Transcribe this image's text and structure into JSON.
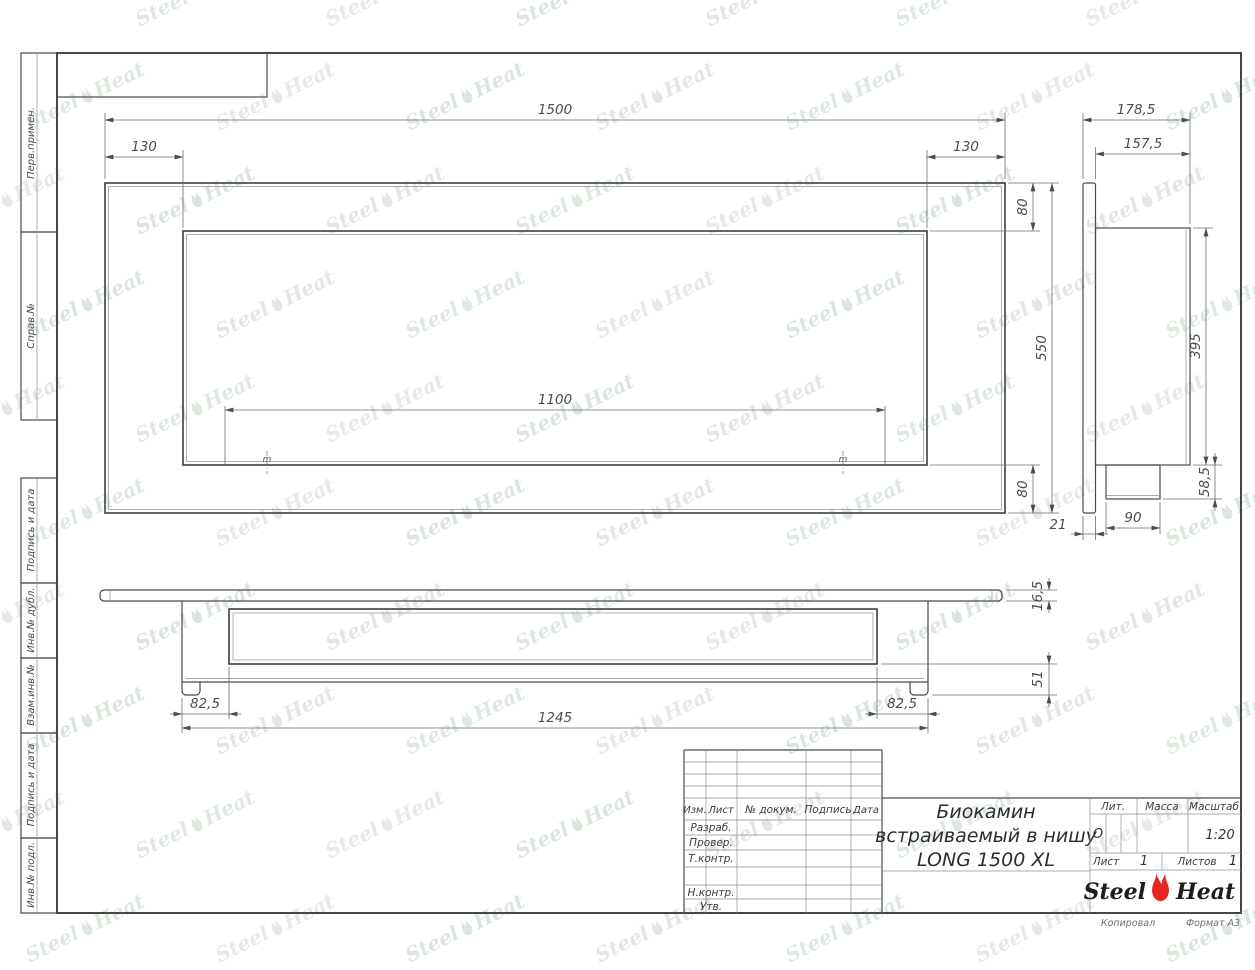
{
  "watermark": {
    "text_left": "Steel",
    "text_right": "Heat"
  },
  "sidebar": {
    "labels": [
      "Перв.примен.",
      "Справ.№",
      "Подпись и дата",
      "Инв.№ дубл.",
      "Взам.инв.№",
      "Подпись и дата",
      "Инв.№ подл."
    ]
  },
  "drawing": {
    "front_view": {
      "dims": {
        "overall_width": "1500",
        "left_offset": "130",
        "right_offset": "130",
        "top_offset": "80",
        "overall_height": "550",
        "opening_width": "1100",
        "bottom_offset": "80"
      },
      "mount_mark": "m"
    },
    "side_view": {
      "dims": {
        "overall_depth": "178,5",
        "body_depth": "157,5",
        "body_height": "395",
        "box_height": "58,5",
        "box_depth": "90",
        "panel_thickness": "21"
      }
    },
    "plan_view": {
      "dims": {
        "flange_thickness": "16,5",
        "body_drop": "51",
        "left_inset": "82,5",
        "body_length": "1245",
        "right_inset": "82,5"
      }
    }
  },
  "title_block": {
    "header_cols": [
      "Изм.",
      "Лист",
      "№ докум.",
      "Подпись",
      "Дата"
    ],
    "row_labels": [
      "Разраб.",
      "Провер.",
      "Т.контр.",
      "Н.контр.",
      "Утв."
    ],
    "title_lines": [
      "Биокамин",
      "встраиваемый в нишу",
      "LONG 1500 XL"
    ],
    "lit_label": "Лит.",
    "lit_value": "О",
    "mass_label": "Масса",
    "scale_label": "Масштаб",
    "scale_value": "1:20",
    "sheet_label": "Лист",
    "sheet_value": "1",
    "sheets_label": "Листов",
    "sheets_value": "1",
    "brand": {
      "steel": "Steel",
      "heat": "Heat"
    }
  },
  "footer": {
    "copied_by": "Копировал",
    "format": "Формат А3"
  }
}
